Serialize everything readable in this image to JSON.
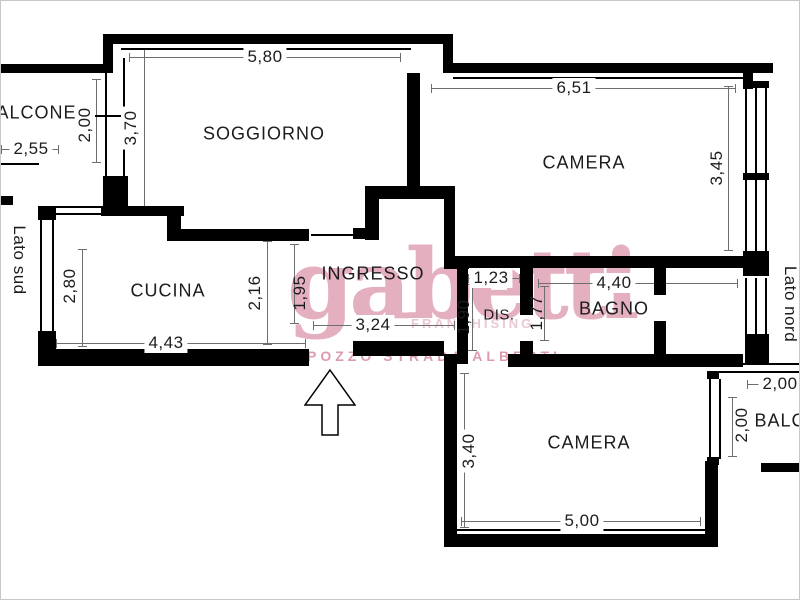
{
  "plan_title": "apartment-floor-plan",
  "rooms": {
    "soggiorno": {
      "label": "SOGGIORNO",
      "width": "5,80",
      "height": "3,70"
    },
    "cucina": {
      "label": "CUCINA",
      "width": "4,43",
      "height": "2,80",
      "door_side": "2,16"
    },
    "ingresso": {
      "label": "INGRESSO",
      "width": "3,24",
      "height": "1,95"
    },
    "camera_nord": {
      "label": "CAMERA",
      "width": "6,51",
      "height": "3,45"
    },
    "dis": {
      "label": "DIS.",
      "width": "1,23",
      "height": "1,90"
    },
    "bagno": {
      "label": "BAGNO",
      "width": "4,40",
      "height": "1,77"
    },
    "camera_sud": {
      "label": "CAMERA",
      "width": "5,00",
      "height": "3,40"
    },
    "balcone_sud": {
      "label": "BALCONE",
      "width": "2,55",
      "depth": "2,00"
    },
    "balcone_nord": {
      "label": "BALCONE",
      "width": "2,00",
      "depth": "2,00"
    }
  },
  "sides": {
    "south": "Lato sud",
    "north": "Lato nord"
  },
  "watermark": {
    "brand": "gabetti",
    "subtitle": "FRANCHISING",
    "agency_line": "POZZO STRADA ALBERTI",
    "brand_color": "#e2a7b8",
    "subtitle_color": "#eac8d3",
    "line_color": "#dc9bad"
  },
  "drawing": {
    "wall_color": "#000000",
    "dimension_line_color": "#6e6e6e",
    "text_color": "#1c1c1c",
    "background": "#ffffff"
  }
}
